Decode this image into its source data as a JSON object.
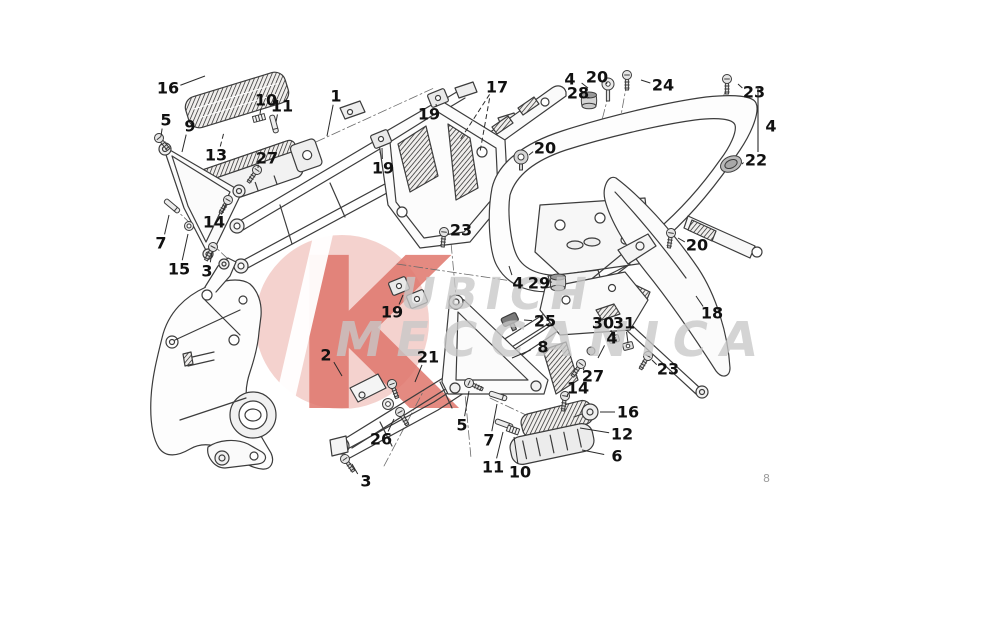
{
  "page": {
    "number": "8",
    "background": "#ffffff"
  },
  "watermark": {
    "logo_letter": "K",
    "line1": "UBICH",
    "line2": "MECCANICA",
    "circle_color": "#f3cdc9",
    "logo_letter_color": "#e0766c",
    "slash_color": "#ffffff",
    "text_color": "#c8c8c8"
  },
  "style": {
    "line_color": "#3c3c3c",
    "label_color": "#111111",
    "leader_color": "#2b2b2b",
    "page_number_color": "#9c9c9c"
  },
  "callouts": [
    {
      "part": "16",
      "x": 168,
      "y": 88,
      "tx": 205,
      "ty": 76
    },
    {
      "part": "10",
      "x": 266,
      "y": 100,
      "tx": 260,
      "ty": 114
    },
    {
      "part": "11",
      "x": 282,
      "y": 106,
      "tx": 276,
      "ty": 122
    },
    {
      "part": "1",
      "x": 336,
      "y": 96,
      "tx": 327,
      "ty": 136
    },
    {
      "part": "5",
      "x": 166,
      "y": 120,
      "tx": 161,
      "ty": 136
    },
    {
      "part": "9",
      "x": 190,
      "y": 126,
      "tx": 182,
      "ty": 152
    },
    {
      "part": "13",
      "x": 216,
      "y": 155,
      "tx": 224,
      "ty": 132,
      "dash": true
    },
    {
      "part": "27",
      "x": 267,
      "y": 158,
      "tx": 258,
      "ty": 168
    },
    {
      "part": "19",
      "x": 383,
      "y": 168,
      "tx": 382,
      "ty": 148
    },
    {
      "part": "19",
      "x": 429,
      "y": 114,
      "tx": 436,
      "ty": 104
    },
    {
      "part": "14",
      "x": 214,
      "y": 222,
      "tx": 226,
      "ty": 204
    },
    {
      "part": "7",
      "x": 161,
      "y": 243,
      "tx": 169,
      "ty": 215
    },
    {
      "part": "15",
      "x": 179,
      "y": 269,
      "tx": 188,
      "ty": 234
    },
    {
      "part": "3",
      "x": 207,
      "y": 271,
      "tx": 212,
      "ty": 252
    },
    {
      "part": "17",
      "x": 497,
      "y": 87,
      "tx": 460,
      "ty": 140,
      "tx2": 480,
      "ty2": 152,
      "dash": true
    },
    {
      "part": "4",
      "x": 570,
      "y": 79,
      "tx": 588,
      "ty": 88
    },
    {
      "part": "20",
      "x": 597,
      "y": 77,
      "tx": 606,
      "ty": 84
    },
    {
      "part": "28",
      "x": 578,
      "y": 93,
      "tx": 587,
      "ty": 98
    },
    {
      "part": "24",
      "x": 663,
      "y": 85,
      "tx": 641,
      "ty": 80
    },
    {
      "part": "23",
      "x": 754,
      "y": 92,
      "tx": 738,
      "ty": 84
    },
    {
      "part": "4",
      "x": 771,
      "y": 126,
      "bracket": [
        758,
        86,
        758,
        152
      ]
    },
    {
      "part": "22",
      "x": 756,
      "y": 160,
      "tx": 742,
      "ty": 164
    },
    {
      "part": "20",
      "x": 545,
      "y": 148,
      "tx": 529,
      "ty": 155
    },
    {
      "part": "23",
      "x": 461,
      "y": 230,
      "tx": 448,
      "ty": 234
    },
    {
      "part": "20",
      "x": 697,
      "y": 245,
      "tx": 678,
      "ty": 238
    },
    {
      "part": "4",
      "x": 518,
      "y": 283,
      "tx": 509,
      "ty": 266
    },
    {
      "part": "29",
      "x": 539,
      "y": 283,
      "tx": 550,
      "ty": 282
    },
    {
      "part": "2",
      "x": 326,
      "y": 355,
      "tx": 342,
      "ty": 376
    },
    {
      "part": "19",
      "x": 392,
      "y": 312,
      "tx": 403,
      "ty": 295
    },
    {
      "part": "21",
      "x": 428,
      "y": 357,
      "tx": 415,
      "ty": 382
    },
    {
      "part": "25",
      "x": 545,
      "y": 321,
      "tx": 524,
      "ty": 320
    },
    {
      "part": "8",
      "x": 543,
      "y": 347,
      "tx": 512,
      "ty": 358
    },
    {
      "part": "30",
      "x": 603,
      "y": 323,
      "tx": 613,
      "ty": 336
    },
    {
      "part": "31",
      "x": 624,
      "y": 323,
      "tx": 628,
      "ty": 343
    },
    {
      "part": "4",
      "x": 612,
      "y": 338,
      "tx": 598,
      "ty": 358
    },
    {
      "part": "27",
      "x": 593,
      "y": 376,
      "tx": 584,
      "ty": 368
    },
    {
      "part": "23",
      "x": 668,
      "y": 369,
      "tx": 652,
      "ty": 360
    },
    {
      "part": "18",
      "x": 712,
      "y": 313,
      "tx": 696,
      "ty": 296
    },
    {
      "part": "26",
      "x": 381,
      "y": 439,
      "tx": 394,
      "ty": 419
    },
    {
      "part": "3",
      "x": 366,
      "y": 481,
      "tx": 352,
      "ty": 464
    },
    {
      "part": "14",
      "x": 578,
      "y": 388,
      "tx": 567,
      "ty": 397
    },
    {
      "part": "16",
      "x": 628,
      "y": 412,
      "tx": 600,
      "ty": 412
    },
    {
      "part": "12",
      "x": 622,
      "y": 434,
      "tx": 580,
      "ty": 428
    },
    {
      "part": "6",
      "x": 617,
      "y": 456,
      "tx": 582,
      "ty": 450
    },
    {
      "part": "5",
      "x": 462,
      "y": 425,
      "tx": 469,
      "ty": 391
    },
    {
      "part": "7",
      "x": 489,
      "y": 440,
      "tx": 497,
      "ty": 404
    },
    {
      "part": "11",
      "x": 493,
      "y": 467,
      "tx": 503,
      "ty": 432
    },
    {
      "part": "10",
      "x": 520,
      "y": 472,
      "tx": 514,
      "ty": 437
    }
  ],
  "fasteners": [
    {
      "type": "screw",
      "name": "bolt-front-5",
      "x": 159,
      "y": 138,
      "angle": -40
    },
    {
      "type": "screw",
      "name": "screw-front-27",
      "x": 257,
      "y": 170,
      "angle": 35
    },
    {
      "type": "spring",
      "name": "spring-front-10",
      "x": 259,
      "y": 118,
      "angle": -15
    },
    {
      "type": "pin",
      "name": "pin-front-11",
      "x": 274,
      "y": 124,
      "angle": 75
    },
    {
      "type": "screw",
      "name": "screw-front-14",
      "x": 228,
      "y": 200,
      "angle": 30
    },
    {
      "type": "pin",
      "name": "pin-front-7",
      "x": 172,
      "y": 206,
      "angle": 40
    },
    {
      "type": "nut",
      "name": "nut-15",
      "x": 189,
      "y": 226,
      "angle": 0
    },
    {
      "type": "screw",
      "name": "bolt-front-3",
      "x": 213,
      "y": 247,
      "angle": 28
    },
    {
      "type": "screw",
      "name": "screw-top-23",
      "x": 727,
      "y": 79,
      "angle": 0
    },
    {
      "type": "screw",
      "name": "screw-24",
      "x": 627,
      "y": 75,
      "angle": 0
    },
    {
      "type": "washer_screw",
      "name": "screw-top-20",
      "x": 608,
      "y": 84,
      "angle": 0
    },
    {
      "type": "grommet",
      "name": "grommet-28",
      "x": 589,
      "y": 100,
      "angle": 0
    },
    {
      "type": "grommet",
      "name": "grommet-29",
      "x": 558,
      "y": 282,
      "angle": 0
    },
    {
      "type": "cap",
      "name": "cap-22",
      "x": 731,
      "y": 164,
      "angle": -25
    },
    {
      "type": "mount",
      "name": "rubber-mount-20",
      "x": 521,
      "y": 157,
      "angle": 0
    },
    {
      "type": "screw",
      "name": "screw-mid-23",
      "x": 444,
      "y": 232,
      "angle": 5
    },
    {
      "type": "screw",
      "name": "screw-right-20",
      "x": 671,
      "y": 233,
      "angle": 8
    },
    {
      "type": "screw",
      "name": "screw-right-23",
      "x": 648,
      "y": 356,
      "angle": 30
    },
    {
      "type": "screw",
      "name": "screw-rear-27",
      "x": 581,
      "y": 364,
      "angle": 35
    },
    {
      "type": "screw",
      "name": "bolt-rear-5",
      "x": 469,
      "y": 383,
      "angle": -65
    },
    {
      "type": "pin",
      "name": "pin-rear-7",
      "x": 498,
      "y": 396,
      "angle": 18
    },
    {
      "type": "pin",
      "name": "pin-rear-11",
      "x": 504,
      "y": 424,
      "angle": 20
    },
    {
      "type": "spring",
      "name": "spring-rear-10",
      "x": 513,
      "y": 430,
      "angle": 20
    },
    {
      "type": "screw",
      "name": "screw-rear-14",
      "x": 565,
      "y": 396,
      "angle": 8
    },
    {
      "type": "screw",
      "name": "screw-rear-3",
      "x": 345,
      "y": 459,
      "angle": -35
    },
    {
      "type": "washer",
      "name": "washer-26",
      "x": 388,
      "y": 404,
      "angle": 0
    },
    {
      "type": "screw",
      "name": "bolt-26",
      "x": 400,
      "y": 412,
      "angle": -30
    },
    {
      "type": "screw",
      "name": "screw-26b",
      "x": 392,
      "y": 384,
      "angle": -20
    },
    {
      "type": "clip",
      "name": "clip-30",
      "x": 614,
      "y": 339,
      "angle": -15
    },
    {
      "type": "clip",
      "name": "clip-31",
      "x": 628,
      "y": 346,
      "angle": -15
    },
    {
      "type": "ball",
      "name": "screw-head-4",
      "x": 591,
      "y": 351,
      "angle": 0
    }
  ]
}
